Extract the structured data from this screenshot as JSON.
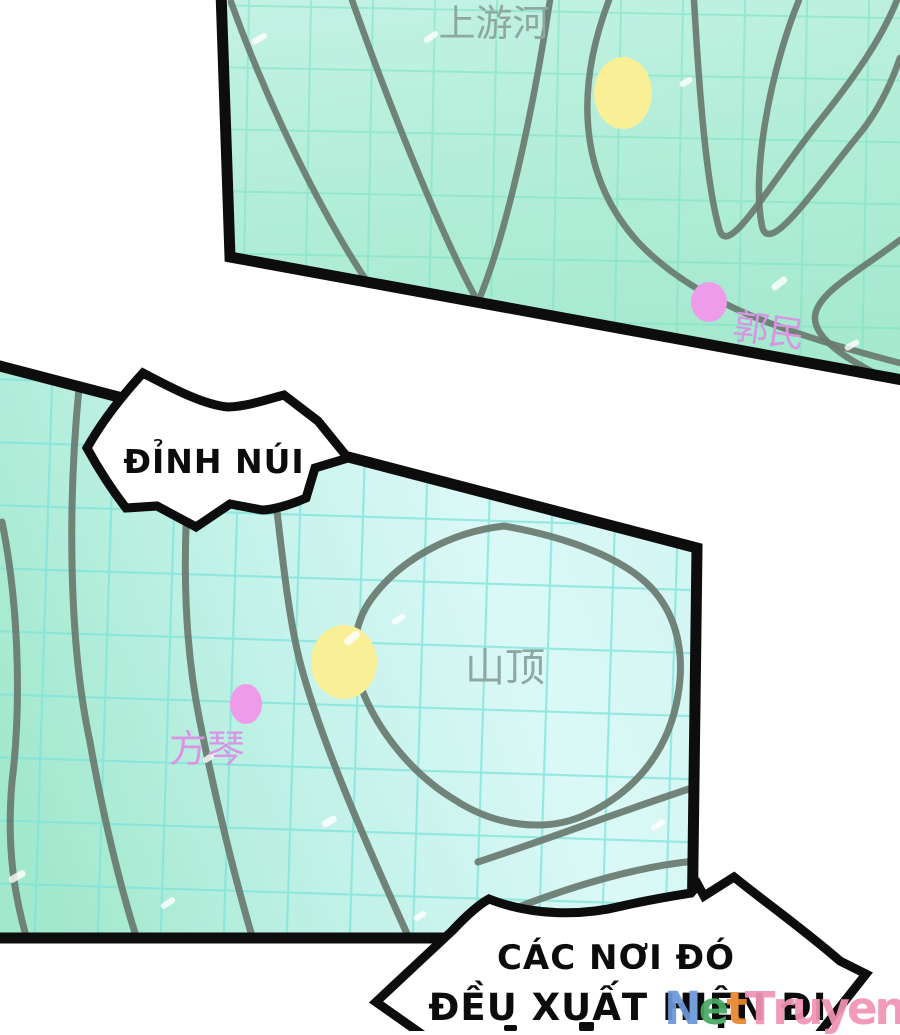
{
  "panel_top_map": {
    "river_label": "上游河",
    "marker_label": "郭民"
  },
  "panel_bottom_map": {
    "peak_label": "山顶",
    "marker_label": "方琴"
  },
  "callout_peak": {
    "text": "ĐỈNH NÚI"
  },
  "callout_bottom": {
    "line1": "CÁC NƠI ĐÓ",
    "line2": "ĐỀU XUẤT HIỆN ĐI"
  },
  "watermark": {
    "text": "NetTruyen",
    "letters": [
      {
        "char": "N",
        "color": "#6b97d8"
      },
      {
        "char": "e",
        "color": "#4aa865"
      },
      {
        "char": "t",
        "color": "#e8872e"
      },
      {
        "char": "T",
        "color": "#f293b4"
      },
      {
        "char": "r",
        "color": "#f293b4"
      },
      {
        "char": "u",
        "color": "#f293b4"
      },
      {
        "char": "y",
        "color": "#f293b4"
      },
      {
        "char": "e",
        "color": "#f293b4"
      },
      {
        "char": "n",
        "color": "#f293b4"
      }
    ]
  },
  "colors": {
    "map1_bg_light": "#c4f2e4",
    "map1_bg_dark": "#a5e9cf",
    "map2_bg_left": "#a2e8cd",
    "map2_bg_mid": "#c3f2e9",
    "map2_bg_right": "#daf8f6",
    "grid_top": "#7fe3c6",
    "grid_bottom": "#7ce2da",
    "contour_line": "#69796f",
    "yellow_marker": "#f8ef97",
    "pink_marker": "#ee9bea",
    "pink_text": "#d995e3",
    "gray_text": "#8fa7a1",
    "panel_border": "#0d0d0d"
  }
}
